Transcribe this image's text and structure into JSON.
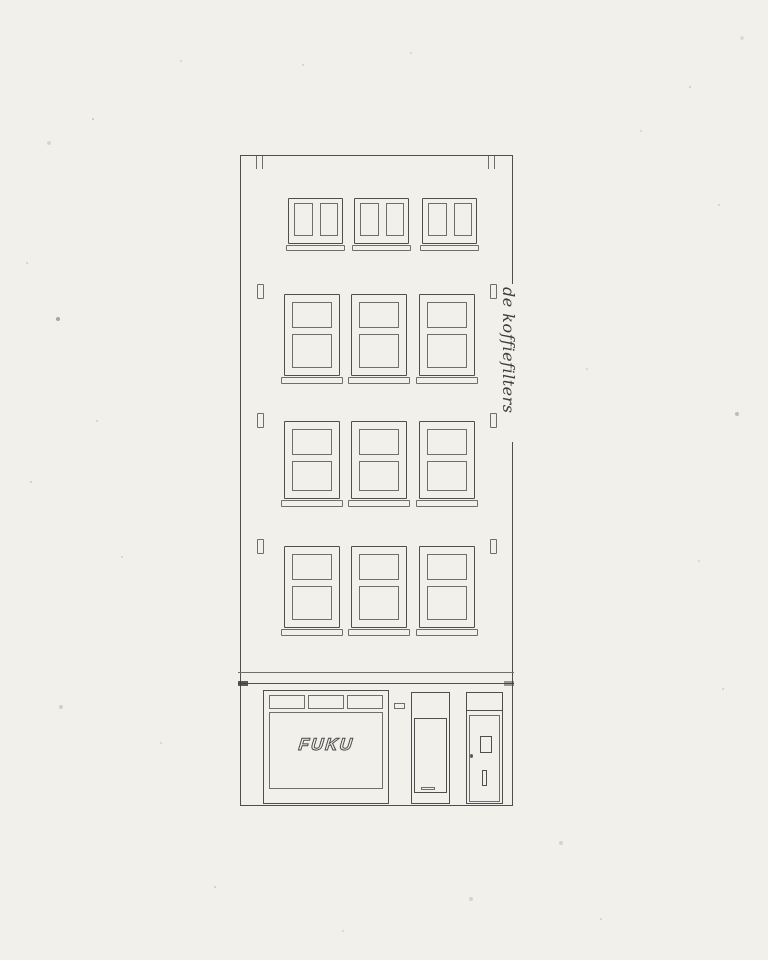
{
  "palette": {
    "paper_color": "#f1f0eb",
    "line_color": "#4e4e4e",
    "line_soft_color": "#6e6e6e"
  },
  "illustration": {
    "shop_sign": "FUKU",
    "side_script": "de koffiefilters",
    "floors": [
      {
        "name": "attic",
        "windows": 3
      },
      {
        "name": "third",
        "windows": 3
      },
      {
        "name": "second",
        "windows": 3
      },
      {
        "name": "first",
        "windows": 3
      }
    ],
    "storefront": {
      "transom_panes": 3,
      "units": [
        "shop-window",
        "entrance-door",
        "residence-door"
      ]
    }
  }
}
